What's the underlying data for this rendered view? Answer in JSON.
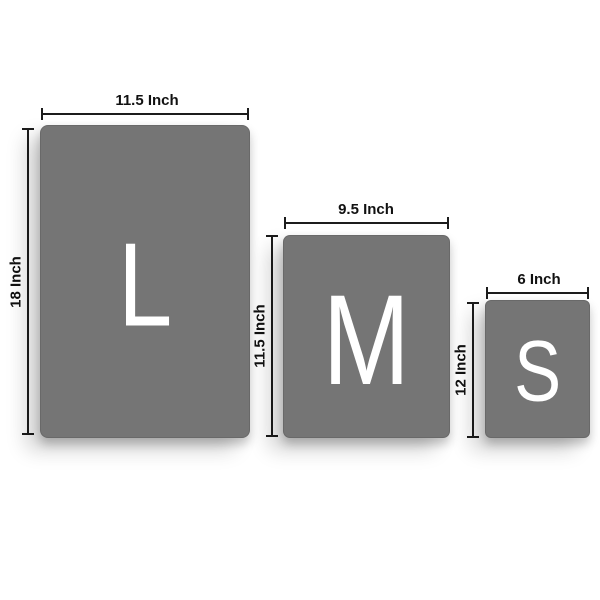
{
  "colors": {
    "panel": "#757575",
    "dimension_line": "#1c1c1c",
    "label_text": "#111111",
    "letter": "#ffffff",
    "background": "#ffffff"
  },
  "sizes": [
    {
      "name": "large",
      "letter": "L",
      "width_label": "11.5 Inch",
      "height_label": "18 Inch"
    },
    {
      "name": "medium",
      "letter": "M",
      "width_label": "9.5 Inch",
      "height_label": "11.5 Inch"
    },
    {
      "name": "small",
      "letter": "S",
      "width_label": "6 Inch",
      "height_label": "12 Inch"
    }
  ]
}
